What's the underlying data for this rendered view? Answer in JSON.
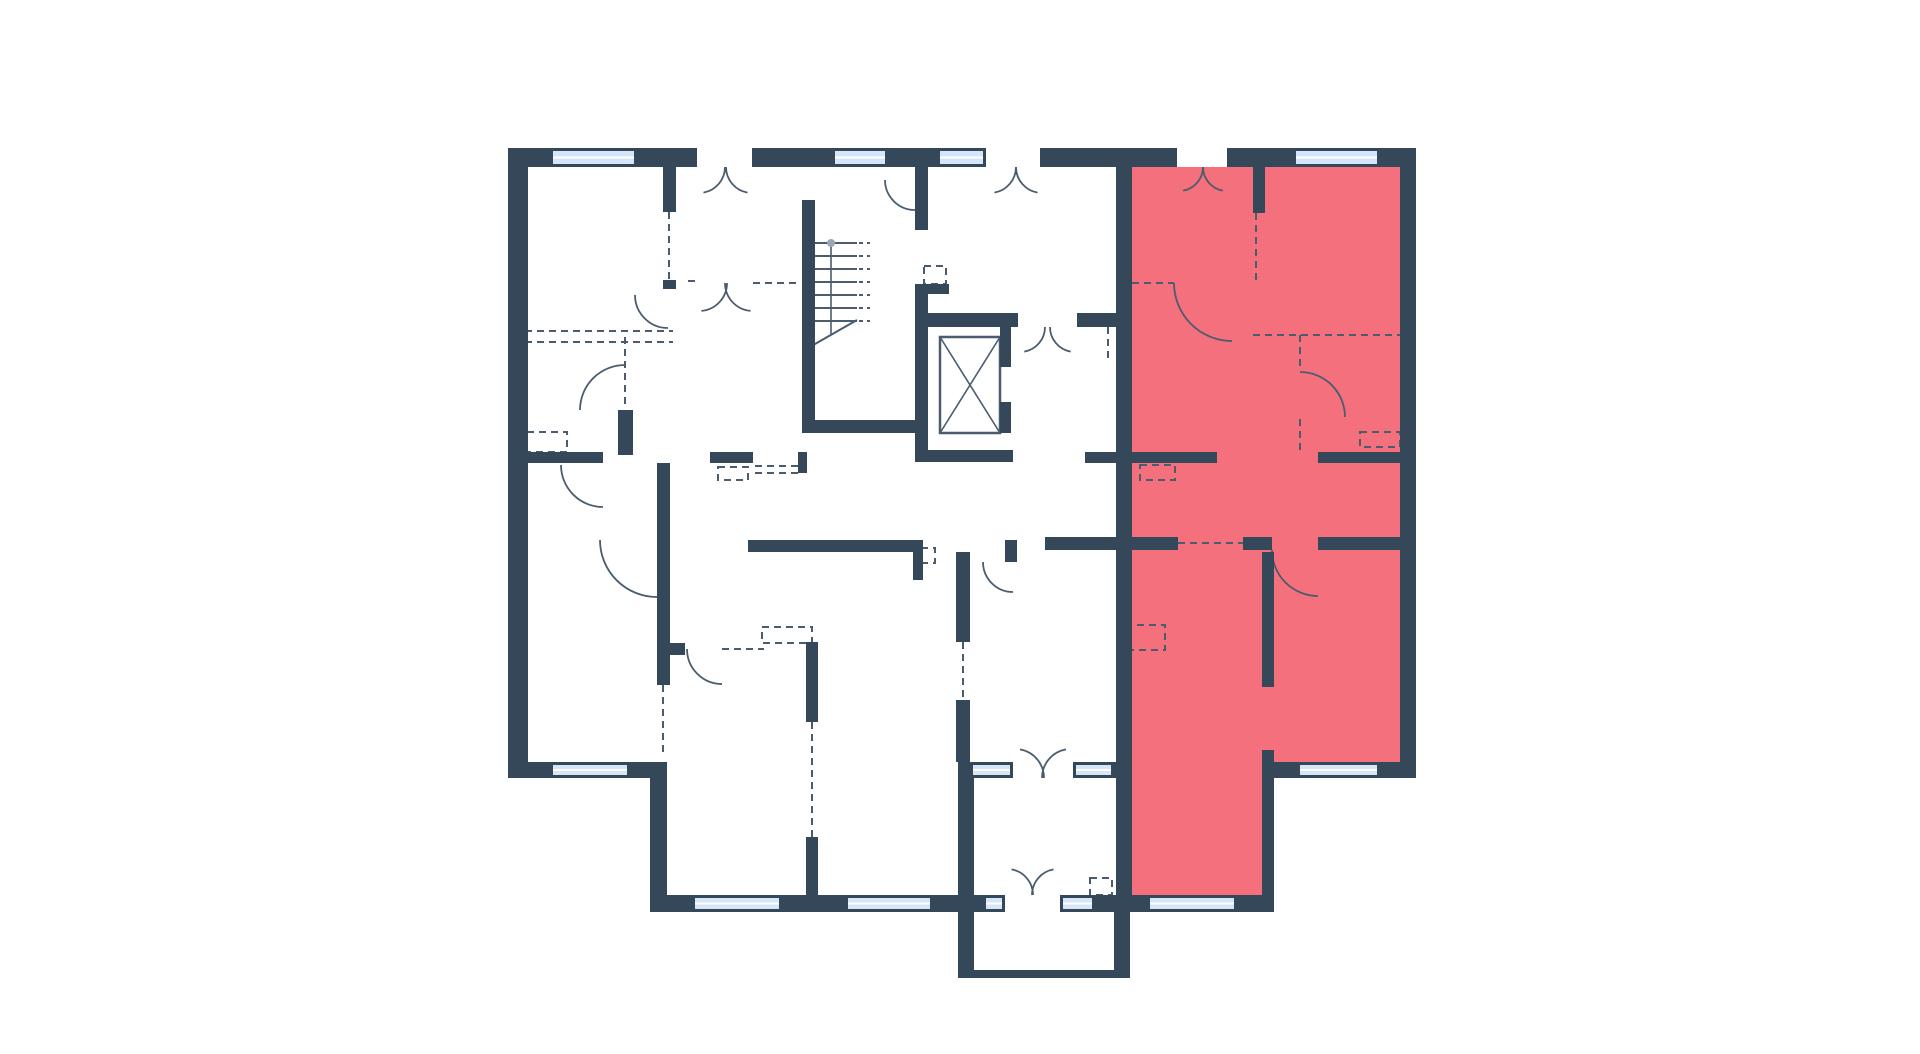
{
  "canvas": {
    "width": 1920,
    "height": 1054,
    "background": "#ffffff"
  },
  "palette": {
    "wall": "#35485A",
    "line": "#4A5C6E",
    "window_fill": "#D4E6F8",
    "window_glaze_line": "#FFFFFF",
    "highlight": "#F4707C"
  },
  "floorplan": {
    "highlight_regions": [
      {
        "name": "selected-apartment-region",
        "interactable": true,
        "points": "1132,167 1400,167 1400,762 1274,762 1274,895 1132,895"
      }
    ],
    "walls": [
      [
        508,
        148,
        42,
        19
      ],
      [
        637,
        148,
        60,
        19
      ],
      [
        752,
        148,
        80,
        19
      ],
      [
        888,
        148,
        49,
        19
      ],
      [
        1040,
        148,
        137,
        19
      ],
      [
        1227,
        148,
        66,
        19
      ],
      [
        1380,
        148,
        36,
        19
      ],
      [
        508,
        148,
        20,
        630
      ],
      [
        508,
        762,
        42,
        16
      ],
      [
        630,
        762,
        37,
        16
      ],
      [
        650,
        778,
        17,
        134
      ],
      [
        650,
        895,
        42,
        17
      ],
      [
        782,
        895,
        63,
        17
      ],
      [
        933,
        895,
        35,
        17
      ],
      [
        968,
        895,
        15,
        17
      ],
      [
        1095,
        895,
        21,
        17
      ],
      [
        958,
        762,
        12,
        16
      ],
      [
        1108,
        762,
        8,
        16
      ],
      [
        958,
        778,
        16,
        194
      ],
      [
        1114,
        912,
        16,
        64
      ],
      [
        958,
        970,
        172,
        8
      ],
      [
        1400,
        148,
        16,
        630
      ],
      [
        1272,
        762,
        25,
        16
      ],
      [
        1380,
        762,
        36,
        16
      ],
      [
        1132,
        895,
        15,
        17
      ],
      [
        1237,
        895,
        37,
        17
      ],
      [
        1116,
        167,
        16,
        745
      ],
      [
        1253,
        167,
        12,
        46
      ],
      [
        1132,
        452,
        85,
        11
      ],
      [
        1318,
        452,
        84,
        11
      ],
      [
        1045,
        537,
        133,
        13
      ],
      [
        1243,
        537,
        29,
        13
      ],
      [
        1318,
        537,
        84,
        13
      ],
      [
        1262,
        552,
        12,
        135
      ],
      [
        1262,
        750,
        12,
        162
      ],
      [
        802,
        200,
        13,
        233
      ],
      [
        802,
        420,
        115,
        13
      ],
      [
        915,
        167,
        13,
        63
      ],
      [
        915,
        284,
        13,
        178
      ],
      [
        927,
        284,
        22,
        10
      ],
      [
        927,
        313,
        91,
        14
      ],
      [
        1077,
        313,
        39,
        14
      ],
      [
        1000,
        327,
        11,
        40
      ],
      [
        1000,
        402,
        11,
        31
      ],
      [
        915,
        450,
        98,
        12
      ],
      [
        663,
        167,
        13,
        45
      ],
      [
        663,
        280,
        13,
        9
      ],
      [
        508,
        452,
        95,
        11
      ],
      [
        618,
        410,
        15,
        45
      ],
      [
        657,
        463,
        13,
        222
      ],
      [
        657,
        643,
        28,
        12
      ],
      [
        710,
        452,
        43,
        11
      ],
      [
        798,
        452,
        9,
        21
      ],
      [
        806,
        642,
        12,
        80
      ],
      [
        806,
        837,
        12,
        58
      ],
      [
        748,
        540,
        165,
        12
      ],
      [
        913,
        540,
        10,
        40
      ],
      [
        1005,
        540,
        12,
        22
      ],
      [
        1085,
        452,
        47,
        11
      ],
      [
        956,
        552,
        14,
        90
      ],
      [
        956,
        700,
        14,
        62
      ]
    ],
    "windows": [
      [
        550,
        148,
        87,
        19
      ],
      [
        832,
        148,
        56,
        19
      ],
      [
        937,
        148,
        49,
        19
      ],
      [
        1293,
        148,
        87,
        19
      ],
      [
        550,
        762,
        80,
        16
      ],
      [
        692,
        895,
        90,
        17
      ],
      [
        845,
        895,
        88,
        17
      ],
      [
        983,
        895,
        22,
        17
      ],
      [
        1060,
        895,
        35,
        17
      ],
      [
        970,
        762,
        43,
        16
      ],
      [
        1073,
        762,
        41,
        16
      ],
      [
        1147,
        895,
        90,
        17
      ],
      [
        1297,
        762,
        83,
        16
      ]
    ],
    "doors": [
      [
        699,
        167,
        26,
        0,
        80,
        1
      ],
      [
        752,
        167,
        26,
        180,
        100,
        0
      ],
      [
        990,
        167,
        26,
        0,
        80,
        1
      ],
      [
        1042,
        167,
        26,
        180,
        100,
        0
      ],
      [
        1179,
        167,
        24,
        0,
        80,
        1
      ],
      [
        1227,
        167,
        24,
        180,
        100,
        0
      ],
      [
        1020,
        327,
        25,
        0,
        80,
        1
      ],
      [
        1075,
        327,
        25,
        180,
        100,
        0
      ],
      [
        1015,
        778,
        29,
        0,
        -80,
        0
      ],
      [
        1071,
        778,
        29,
        180,
        260,
        1
      ],
      [
        1007,
        895,
        26,
        0,
        -80,
        0
      ],
      [
        1058,
        895,
        26,
        180,
        260,
        1
      ],
      [
        1232,
        283,
        58,
        180,
        90,
        0
      ],
      [
        1300,
        417,
        45,
        270,
        360,
        1
      ],
      [
        1318,
        550,
        46,
        180,
        90,
        0
      ],
      [
        668,
        295,
        33,
        180,
        90,
        0
      ],
      [
        603,
        465,
        42,
        90,
        180,
        1
      ],
      [
        625,
        410,
        45,
        270,
        180,
        0
      ],
      [
        657,
        540,
        57,
        180,
        90,
        0
      ],
      [
        722,
        649,
        35,
        180,
        90,
        0
      ],
      [
        1013,
        562,
        30,
        180,
        90,
        0
      ],
      [
        915,
        180,
        30,
        90,
        180,
        1
      ],
      [
        699,
        283,
        28,
        0,
        85,
        1
      ],
      [
        753,
        283,
        28,
        180,
        95,
        0
      ]
    ],
    "dashed_lines": [
      [
        1256,
        213,
        1256,
        281
      ],
      [
        1132,
        283,
        1174,
        283
      ],
      [
        1253,
        335,
        1400,
        335
      ],
      [
        1300,
        335,
        1300,
        370
      ],
      [
        1300,
        419,
        1300,
        453
      ],
      [
        1108,
        327,
        1108,
        358
      ],
      [
        669,
        212,
        669,
        287
      ],
      [
        525,
        331,
        673,
        331
      ],
      [
        525,
        342,
        673,
        342
      ],
      [
        625,
        337,
        625,
        408
      ],
      [
        663,
        685,
        663,
        752
      ],
      [
        812,
        722,
        812,
        837
      ],
      [
        722,
        649,
        764,
        649
      ],
      [
        688,
        281,
        697,
        281
      ],
      [
        753,
        283,
        800,
        283
      ],
      [
        963,
        642,
        963,
        700
      ],
      [
        1178,
        543,
        1243,
        543
      ],
      [
        755,
        466,
        798,
        466
      ],
      [
        755,
        473,
        798,
        473
      ]
    ],
    "dashed_rects": [
      [
        527,
        432,
        40,
        20
      ],
      [
        718,
        467,
        30,
        13
      ],
      [
        762,
        627,
        50,
        16
      ],
      [
        924,
        266,
        22,
        18
      ],
      [
        921,
        548,
        14,
        15
      ],
      [
        1140,
        465,
        35,
        15
      ],
      [
        1360,
        432,
        40,
        15
      ],
      [
        1090,
        878,
        22,
        17
      ],
      [
        1125,
        625,
        40,
        25
      ]
    ],
    "stairs": {
      "name": "staircase-icon",
      "tread_ys": [
        243,
        256,
        269,
        282,
        295,
        308,
        321
      ],
      "tread_x1": 810,
      "tread_x2": 857,
      "tick_x2": 870,
      "rail_x": 831,
      "rail_y1": 243,
      "rail_y2": 334,
      "diagonal": [
        808,
        348,
        857,
        320
      ],
      "newel": [
        831,
        243,
        4
      ]
    },
    "elevator": {
      "name": "elevator-icon",
      "cab": [
        940,
        337,
        60,
        96
      ]
    }
  }
}
